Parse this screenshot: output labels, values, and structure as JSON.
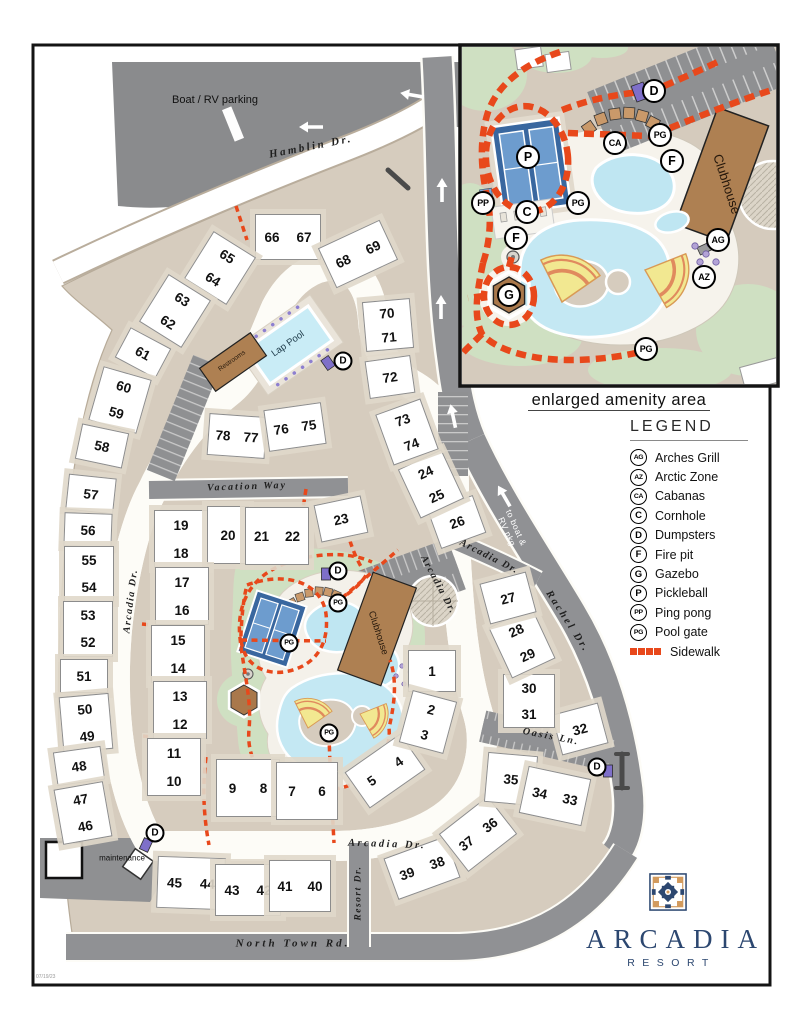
{
  "doc": {
    "date_stamp": "07/19/23"
  },
  "logo": {
    "name": "ARCADIA",
    "subtitle": "RESORT"
  },
  "inset": {
    "caption": "enlarged amenity area",
    "clubhouse": "Clubhouse"
  },
  "areas": {
    "boat_rv": "Boat / RV parking",
    "maintenance": "maintenance",
    "restrooms": "Restrooms",
    "lap_pool": "Lap Pool",
    "clubhouse": "Clubhouse"
  },
  "legend": {
    "title": "LEGEND",
    "sidewalk": "Sidewalk",
    "sidewalk_color": "#e8481b",
    "items": [
      {
        "code": "AG",
        "label": "Arches Grill"
      },
      {
        "code": "AZ",
        "label": "Arctic Zone"
      },
      {
        "code": "CA",
        "label": "Cabanas"
      },
      {
        "code": "C",
        "label": "Cornhole"
      },
      {
        "code": "D",
        "label": "Dumpsters"
      },
      {
        "code": "F",
        "label": "Fire pit"
      },
      {
        "code": "G",
        "label": "Gazebo"
      },
      {
        "code": "P",
        "label": "Pickleball"
      },
      {
        "code": "PP",
        "label": "Ping pong"
      },
      {
        "code": "PG",
        "label": "Pool gate"
      }
    ]
  },
  "roads": [
    {
      "label": "Hamblin Dr.",
      "x": 311,
      "y": 147,
      "r": -11,
      "cls": "dark",
      "fs": 11,
      "ls": 2.5
    },
    {
      "label": "Vacation Way",
      "x": 247,
      "y": 487,
      "r": -2,
      "cls": "dark",
      "fs": 10,
      "ls": 2
    },
    {
      "label": "Arcadia Dr.",
      "x": 131,
      "y": 601,
      "r": -83,
      "cls": "dark",
      "fs": 10,
      "ls": 1.5
    },
    {
      "label": "Arcadia Dr.",
      "x": 438,
      "y": 585,
      "r": 62,
      "cls": "dark",
      "fs": 10,
      "ls": 1.5
    },
    {
      "label": "Arcadia Dr.",
      "x": 489,
      "y": 557,
      "r": 27,
      "cls": "dark",
      "fs": 10,
      "ls": 1.5
    },
    {
      "label": "Arcadia Dr.",
      "x": 387,
      "y": 845,
      "r": 2,
      "cls": "dark",
      "fs": 10.5,
      "ls": 2.5
    },
    {
      "label": "Rachel Dr.",
      "x": 567,
      "y": 622,
      "r": 57,
      "cls": "dark",
      "fs": 10.5,
      "ls": 2.5
    },
    {
      "label": "Oasis Ln.",
      "x": 551,
      "y": 737,
      "r": 11,
      "cls": "dark",
      "fs": 10,
      "ls": 2
    },
    {
      "label": "Resort Dr.",
      "x": 359,
      "y": 893,
      "r": -90,
      "cls": "dark",
      "fs": 9.5,
      "ls": 1.5
    },
    {
      "label": "North Town Rd.",
      "x": 293,
      "y": 944,
      "r": 0,
      "cls": "dark",
      "fs": 11,
      "ls": 3
    },
    {
      "label": "to boat &\nRV pkg",
      "x": 511,
      "y": 530,
      "r": 66,
      "cls": "light",
      "fs": 8.5,
      "ls": 0.5
    }
  ],
  "buildings": [
    {
      "n": [
        "66",
        "67"
      ],
      "x": 287,
      "y": 236,
      "w": 64,
      "h": 44,
      "r": 0,
      "d": "h"
    },
    {
      "n": [
        "68",
        "69"
      ],
      "x": 357,
      "y": 253,
      "w": 66,
      "h": 42,
      "r": -25,
      "d": "h"
    },
    {
      "n": [
        "65",
        "64"
      ],
      "x": 219,
      "y": 267,
      "w": 48,
      "h": 54,
      "r": 32,
      "d": "v"
    },
    {
      "n": [
        "63",
        "62"
      ],
      "x": 174,
      "y": 310,
      "w": 48,
      "h": 54,
      "r": 32,
      "d": "v"
    },
    {
      "n": [
        "61"
      ],
      "x": 142,
      "y": 352,
      "w": 44,
      "h": 32,
      "r": 28,
      "d": "s"
    },
    {
      "n": [
        "60",
        "59"
      ],
      "x": 119,
      "y": 399,
      "w": 48,
      "h": 54,
      "r": 16,
      "d": "v"
    },
    {
      "n": [
        "58"
      ],
      "x": 101,
      "y": 445,
      "w": 46,
      "h": 34,
      "r": 12,
      "d": "s"
    },
    {
      "n": [
        "57"
      ],
      "x": 90,
      "y": 493,
      "w": 46,
      "h": 34,
      "r": 6,
      "d": "s"
    },
    {
      "n": [
        "56"
      ],
      "x": 87,
      "y": 529,
      "w": 46,
      "h": 32,
      "r": 2,
      "d": "s"
    },
    {
      "n": [
        "55",
        "54"
      ],
      "x": 88,
      "y": 573,
      "w": 48,
      "h": 54,
      "r": 0,
      "d": "v"
    },
    {
      "n": [
        "53",
        "52"
      ],
      "x": 87,
      "y": 628,
      "w": 48,
      "h": 54,
      "r": 0,
      "d": "v"
    },
    {
      "n": [
        "51"
      ],
      "x": 83,
      "y": 675,
      "w": 46,
      "h": 32,
      "r": 0,
      "d": "s"
    },
    {
      "n": [
        "50",
        "49"
      ],
      "x": 85,
      "y": 722,
      "w": 48,
      "h": 54,
      "r": -5,
      "d": "v"
    },
    {
      "n": [
        "48"
      ],
      "x": 78,
      "y": 765,
      "w": 46,
      "h": 32,
      "r": -8,
      "d": "s"
    },
    {
      "n": [
        "47",
        "46"
      ],
      "x": 82,
      "y": 812,
      "w": 48,
      "h": 54,
      "r": -10,
      "d": "v"
    },
    {
      "n": [
        "45",
        "44"
      ],
      "x": 190,
      "y": 882,
      "w": 66,
      "h": 50,
      "r": 2,
      "d": "h"
    },
    {
      "n": [
        "43",
        "42"
      ],
      "x": 247,
      "y": 889,
      "w": 64,
      "h": 50,
      "r": 0,
      "d": "h"
    },
    {
      "n": [
        "41",
        "40"
      ],
      "x": 299,
      "y": 885,
      "w": 60,
      "h": 50,
      "r": 0,
      "d": "h"
    },
    {
      "n": [
        "39",
        "38"
      ],
      "x": 421,
      "y": 867,
      "w": 64,
      "h": 42,
      "r": -20,
      "d": "h"
    },
    {
      "n": [
        "37",
        "36"
      ],
      "x": 477,
      "y": 833,
      "w": 60,
      "h": 46,
      "r": -38,
      "d": "h"
    },
    {
      "n": [
        "35"
      ],
      "x": 510,
      "y": 778,
      "w": 48,
      "h": 48,
      "r": 5,
      "d": "s"
    },
    {
      "n": [
        "34",
        "33"
      ],
      "x": 554,
      "y": 795,
      "w": 62,
      "h": 46,
      "r": 12,
      "d": "h"
    },
    {
      "n": [
        "32"
      ],
      "x": 579,
      "y": 728,
      "w": 46,
      "h": 40,
      "r": -15,
      "d": "s"
    },
    {
      "n": [
        "30",
        "31"
      ],
      "x": 528,
      "y": 700,
      "w": 50,
      "h": 52,
      "r": 0,
      "d": "v"
    },
    {
      "n": [
        "28",
        "29"
      ],
      "x": 521,
      "y": 642,
      "w": 46,
      "h": 54,
      "r": -25,
      "d": "v"
    },
    {
      "n": [
        "27"
      ],
      "x": 507,
      "y": 597,
      "w": 46,
      "h": 40,
      "r": -15,
      "d": "s"
    },
    {
      "n": [
        "26"
      ],
      "x": 456,
      "y": 521,
      "w": 46,
      "h": 38,
      "r": -20,
      "d": "s"
    },
    {
      "n": [
        "24",
        "25"
      ],
      "x": 430,
      "y": 483,
      "w": 46,
      "h": 52,
      "r": -25,
      "d": "v"
    },
    {
      "n": [
        "73",
        "74"
      ],
      "x": 406,
      "y": 431,
      "w": 46,
      "h": 52,
      "r": -20,
      "d": "v"
    },
    {
      "n": [
        "70",
        "71"
      ],
      "x": 387,
      "y": 324,
      "w": 46,
      "h": 48,
      "r": -5,
      "d": "v"
    },
    {
      "n": [
        "72"
      ],
      "x": 389,
      "y": 376,
      "w": 44,
      "h": 36,
      "r": -8,
      "d": "s"
    },
    {
      "n": [
        "19",
        "18"
      ],
      "x": 180,
      "y": 538,
      "w": 52,
      "h": 56,
      "r": 0,
      "d": "v"
    },
    {
      "n": [
        "20"
      ],
      "x": 227,
      "y": 534,
      "w": 40,
      "h": 56,
      "r": 0,
      "d": "s"
    },
    {
      "n": [
        "21",
        "22"
      ],
      "x": 276,
      "y": 535,
      "w": 62,
      "h": 56,
      "r": 0,
      "d": "h"
    },
    {
      "n": [
        "23"
      ],
      "x": 340,
      "y": 518,
      "w": 46,
      "h": 36,
      "r": -12,
      "d": "s"
    },
    {
      "n": [
        "17",
        "16"
      ],
      "x": 181,
      "y": 595,
      "w": 52,
      "h": 56,
      "r": 0,
      "d": "v"
    },
    {
      "n": [
        "15",
        "14"
      ],
      "x": 177,
      "y": 653,
      "w": 52,
      "h": 56,
      "r": 0,
      "d": "v"
    },
    {
      "n": [
        "13",
        "12"
      ],
      "x": 179,
      "y": 709,
      "w": 52,
      "h": 56,
      "r": 0,
      "d": "v"
    },
    {
      "n": [
        "11",
        "10"
      ],
      "x": 173,
      "y": 766,
      "w": 52,
      "h": 56,
      "r": 0,
      "d": "v"
    },
    {
      "n": [
        "9",
        "8"
      ],
      "x": 247,
      "y": 787,
      "w": 62,
      "h": 56,
      "r": 0,
      "d": "h"
    },
    {
      "n": [
        "7",
        "6"
      ],
      "x": 306,
      "y": 790,
      "w": 60,
      "h": 56,
      "r": 0,
      "d": "h"
    },
    {
      "n": [
        "5",
        "4"
      ],
      "x": 384,
      "y": 770,
      "w": 66,
      "h": 42,
      "r": -35,
      "d": "h"
    },
    {
      "n": [
        "1"
      ],
      "x": 431,
      "y": 670,
      "w": 46,
      "h": 40,
      "r": 0,
      "d": "s"
    },
    {
      "n": [
        "2",
        "3"
      ],
      "x": 427,
      "y": 721,
      "w": 44,
      "h": 52,
      "r": 15,
      "d": "v"
    },
    {
      "n": [
        "78",
        "77"
      ],
      "x": 236,
      "y": 435,
      "w": 56,
      "h": 40,
      "r": 4,
      "d": "h"
    },
    {
      "n": [
        "76",
        "75"
      ],
      "x": 294,
      "y": 426,
      "w": 56,
      "h": 40,
      "r": -8,
      "d": "h"
    }
  ],
  "markers": {
    "main": [
      {
        "c": "D",
        "x": 343,
        "y": 361
      },
      {
        "c": "D",
        "x": 338,
        "y": 571
      },
      {
        "c": "PG",
        "x": 338,
        "y": 603
      },
      {
        "c": "PG",
        "x": 289,
        "y": 643
      },
      {
        "c": "PG",
        "x": 329,
        "y": 733
      },
      {
        "c": "D",
        "x": 155,
        "y": 833
      },
      {
        "c": "D",
        "x": 597,
        "y": 767
      }
    ],
    "inset": [
      {
        "c": "P",
        "x": 528,
        "y": 157
      },
      {
        "c": "PP",
        "x": 483,
        "y": 203
      },
      {
        "c": "C",
        "x": 527,
        "y": 212
      },
      {
        "c": "CA",
        "x": 615,
        "y": 143
      },
      {
        "c": "PG",
        "x": 578,
        "y": 203
      },
      {
        "c": "PG",
        "x": 660,
        "y": 135
      },
      {
        "c": "F",
        "x": 672,
        "y": 161
      },
      {
        "c": "D",
        "x": 654,
        "y": 91
      },
      {
        "c": "F",
        "x": 516,
        "y": 238
      },
      {
        "c": "G",
        "x": 509,
        "y": 295
      },
      {
        "c": "AG",
        "x": 718,
        "y": 240
      },
      {
        "c": "AZ",
        "x": 704,
        "y": 277
      },
      {
        "c": "PG",
        "x": 646,
        "y": 349
      }
    ]
  },
  "arrows": [
    {
      "x": 311,
      "y": 127,
      "r": -90
    },
    {
      "x": 412,
      "y": 95,
      "r": -80
    },
    {
      "x": 442,
      "y": 190,
      "r": 0
    },
    {
      "x": 441,
      "y": 307,
      "r": 0
    },
    {
      "x": 453,
      "y": 416,
      "r": -12
    },
    {
      "x": 504,
      "y": 496,
      "r": -30
    }
  ],
  "dumpsters": [
    {
      "x": 328,
      "y": 363,
      "r": -35,
      "s": 1
    },
    {
      "x": 326,
      "y": 574,
      "r": 0,
      "s": 1
    },
    {
      "x": 146,
      "y": 845,
      "r": 25,
      "s": 1
    },
    {
      "x": 608,
      "y": 771,
      "r": 0,
      "s": 1
    },
    {
      "x": 640,
      "y": 92,
      "r": -20,
      "s": 1.4
    }
  ]
}
